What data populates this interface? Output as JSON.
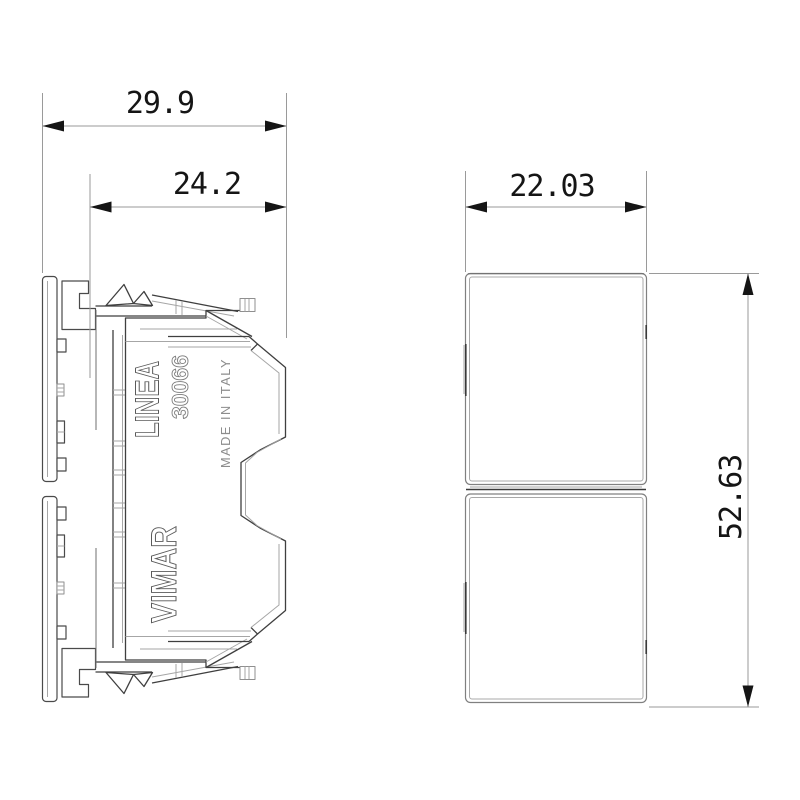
{
  "title": "Technical dimension drawing of a two-module rocker switch",
  "product": {
    "brand": "VIMAR",
    "series": "LINEA",
    "model": "30066",
    "origin": "MADE IN ITALY"
  },
  "dimensions": {
    "overall_depth_mm": "29.9",
    "cover_depth_mm": "24.2",
    "front_width_mm": "22.03",
    "front_height_mm": "52.63"
  },
  "colors": {
    "background": "#ffffff",
    "drawing_line": "#3f3f3f",
    "dimension_line": "#9a9a9a",
    "dimension_text": "#151515",
    "emboss_outline": "#5a5a5a",
    "origin_text": "#8d8d8d"
  }
}
